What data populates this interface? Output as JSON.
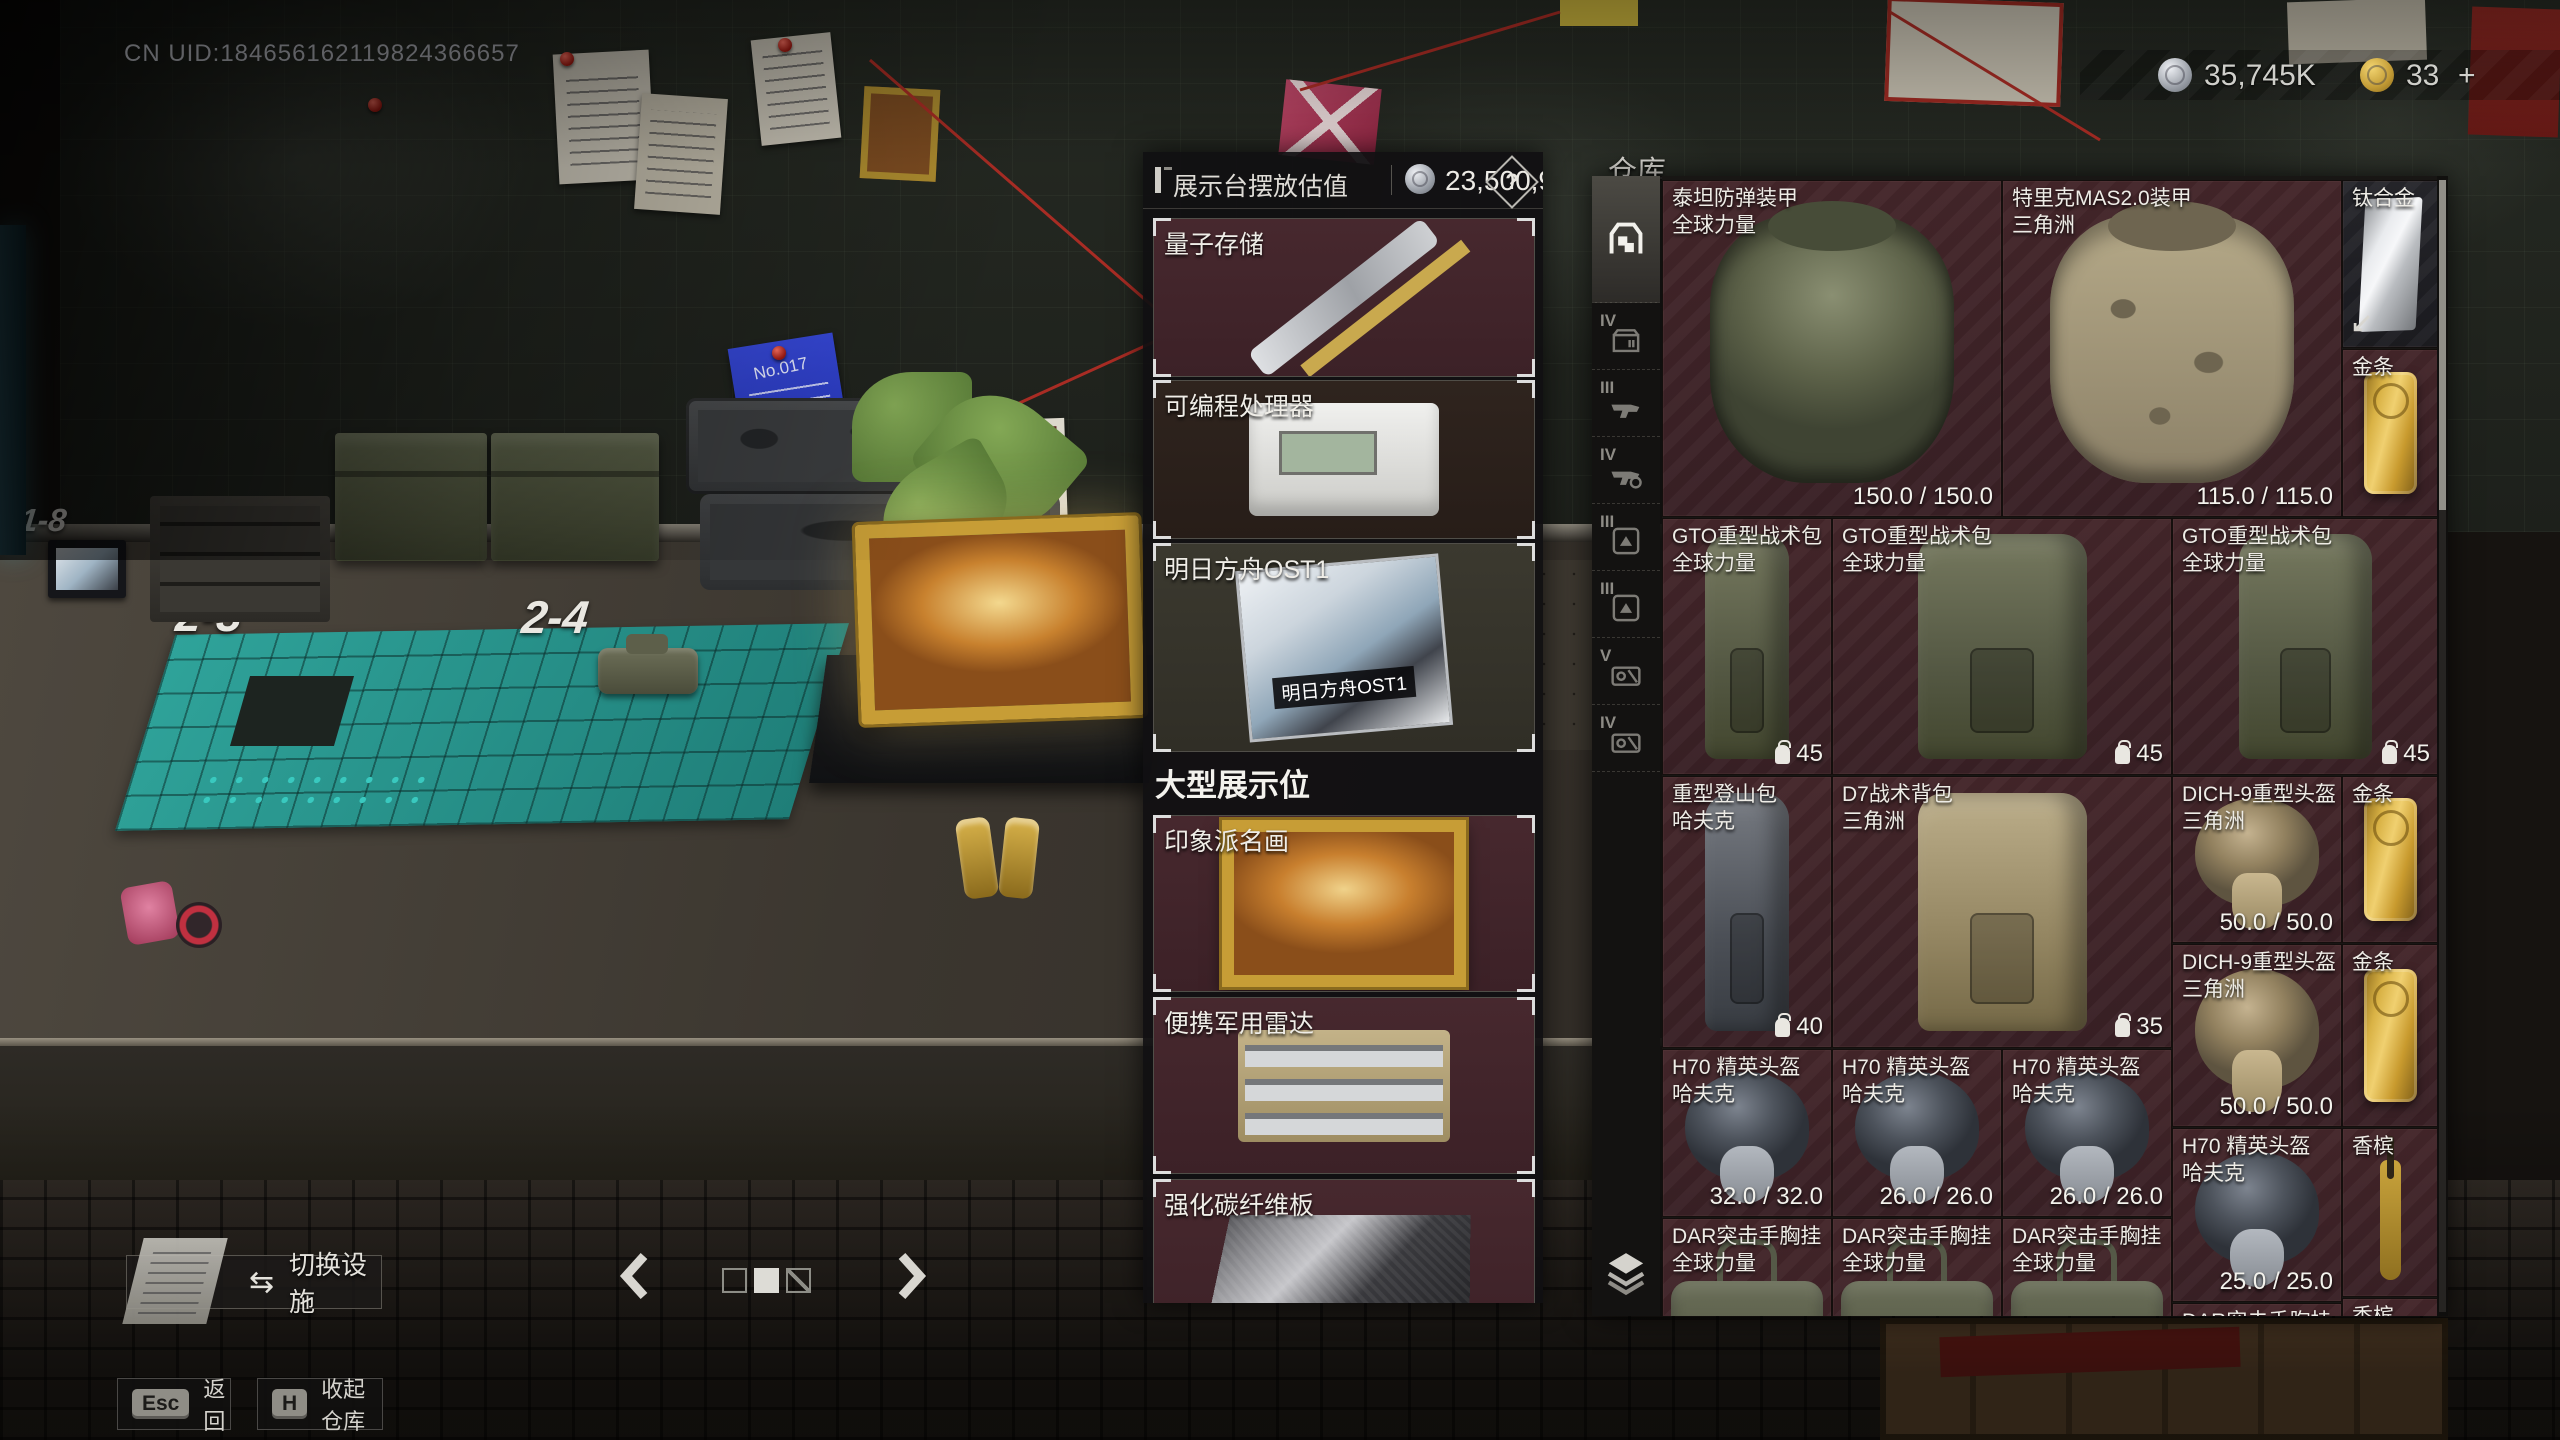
{
  "hud": {
    "uid": "CN UID:184656162119824366657",
    "silver_amount": "35,745K",
    "gold_amount": "33",
    "gold_more": "+"
  },
  "valuation": {
    "title": "展示台摆放估值",
    "value": "23,500,969",
    "help_label": "?",
    "small_slots": [
      {
        "name": "量子存储"
      },
      {
        "name": "可编程处理器"
      },
      {
        "name": "明日方舟OST1",
        "disc_label": "明日方舟OST1"
      }
    ],
    "section_title": "大型展示位",
    "large_slots": [
      {
        "name": "印象派名画"
      },
      {
        "name": "便携军用雷达"
      },
      {
        "name": "强化碳纤维板"
      }
    ]
  },
  "warehouse": {
    "title": "仓库",
    "rail": [
      {
        "label": "",
        "type": "warehouse"
      },
      {
        "label": "IV",
        "type": "container"
      },
      {
        "label": "III",
        "type": "rifle"
      },
      {
        "label": "IV",
        "type": "rifle"
      },
      {
        "label": "III",
        "type": "plate"
      },
      {
        "label": "III",
        "type": "plate"
      },
      {
        "label": "V",
        "type": "keycard"
      },
      {
        "label": "IV",
        "type": "keycard"
      }
    ],
    "items": [
      {
        "name": "泰坦防弹装甲",
        "sub": "全球力量",
        "value": "150.0 / 150.0"
      },
      {
        "name": "特里克MAS2.0装甲",
        "sub": "三角洲",
        "value": "115.0 / 115.0"
      },
      {
        "name": "钛合金"
      },
      {
        "name": "金条"
      },
      {
        "name": "GTO重型战术包",
        "sub": "全球力量",
        "count": "45"
      },
      {
        "name": "GTO重型战术包",
        "sub": "全球力量",
        "count": "45"
      },
      {
        "name": "GTO重型战术包",
        "sub": "全球力量",
        "count": "45"
      },
      {
        "name": "重型登山包",
        "sub": "哈夫克",
        "count": "40"
      },
      {
        "name": "D7战术背包",
        "sub": "三角洲",
        "count": "35"
      },
      {
        "name": "DICH-9重型头盔",
        "sub": "三角洲",
        "value": "50.0 / 50.0"
      },
      {
        "name": "金条"
      },
      {
        "name": "DICH-9重型头盔",
        "sub": "三角洲",
        "value": "50.0 / 50.0"
      },
      {
        "name": "金条"
      },
      {
        "name": "H70 精英头盔",
        "sub": "哈夫克",
        "value": "32.0 / 32.0"
      },
      {
        "name": "H70 精英头盔",
        "sub": "哈夫克",
        "value": "26.0 / 26.0"
      },
      {
        "name": "H70 精英头盔",
        "sub": "哈夫克",
        "value": "26.0 / 26.0"
      },
      {
        "name": "H70 精英头盔",
        "sub": "哈夫克",
        "value": "25.0 / 25.0"
      },
      {
        "name": "香槟"
      },
      {
        "name": "DAR突击手胸挂",
        "sub": "全球力量"
      },
      {
        "name": "DAR突击手胸挂",
        "sub": "全球力量"
      },
      {
        "name": "DAR突击手胸挂",
        "sub": "全球力量"
      },
      {
        "name": "DAR突击手胸挂"
      },
      {
        "name": "香槟"
      }
    ]
  },
  "footer": {
    "switch_facility": "切换设施",
    "switch_icon": "⇆",
    "esc_key": "Esc",
    "esc_label": "返回",
    "h_key": "H",
    "h_label": "收起仓库"
  },
  "world": {
    "slot_label_18": "1-8",
    "slot_label_23": "2-3",
    "slot_label_24": "2-4",
    "sticky_note": "No.017"
  }
}
